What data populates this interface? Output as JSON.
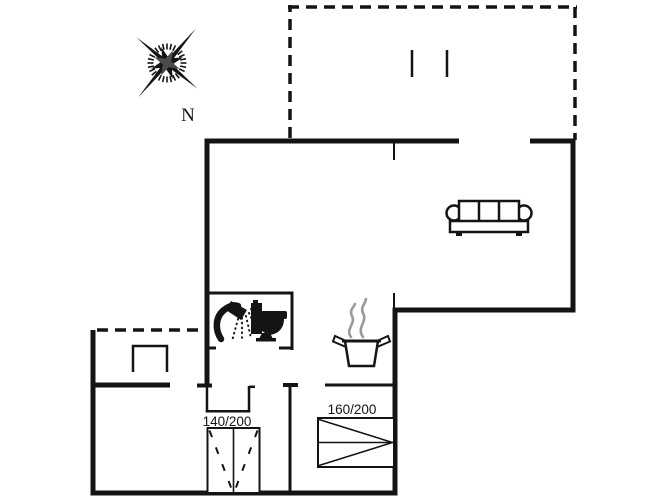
{
  "palette": {
    "background": "#ffffff",
    "ink": "#141414",
    "steam": "#9a9a9a"
  },
  "compass": {
    "label": "N",
    "icon": "compass-rose-icon"
  },
  "beds": {
    "bed1": {
      "label": "140/200"
    },
    "bed2": {
      "label": "160/200"
    }
  },
  "icons": {
    "compass": "compass-rose-icon",
    "sofa": "sofa-icon",
    "shower": "shower-icon",
    "toilet": "toilet-icon",
    "pot": "cooking-pot-icon",
    "steam": "steam-icon",
    "bench": "bench-icon",
    "terrace_marks": "terrace-marks-icon"
  }
}
